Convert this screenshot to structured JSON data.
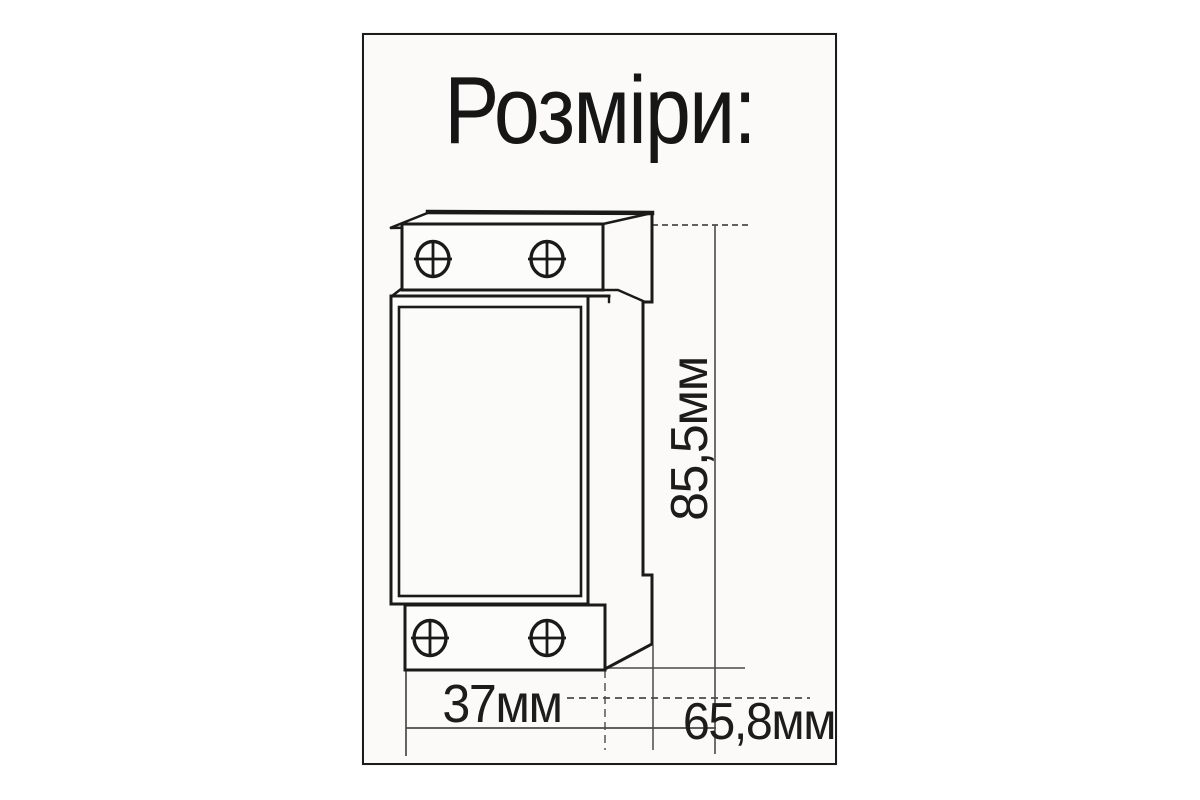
{
  "page": {
    "background": "#ffffff"
  },
  "card": {
    "title": "Розміри:",
    "background": "#fbfaf8",
    "border_color": "#1b1b1b"
  },
  "diagram": {
    "figure_name": "din-rail-module-outline",
    "ink_color": "#1a1a1a",
    "dim_line_color": "#4a4a4a",
    "screw_count": 4,
    "labels": {
      "height": "85,5мм",
      "width": "37мм",
      "depth": "65,8мм"
    }
  }
}
